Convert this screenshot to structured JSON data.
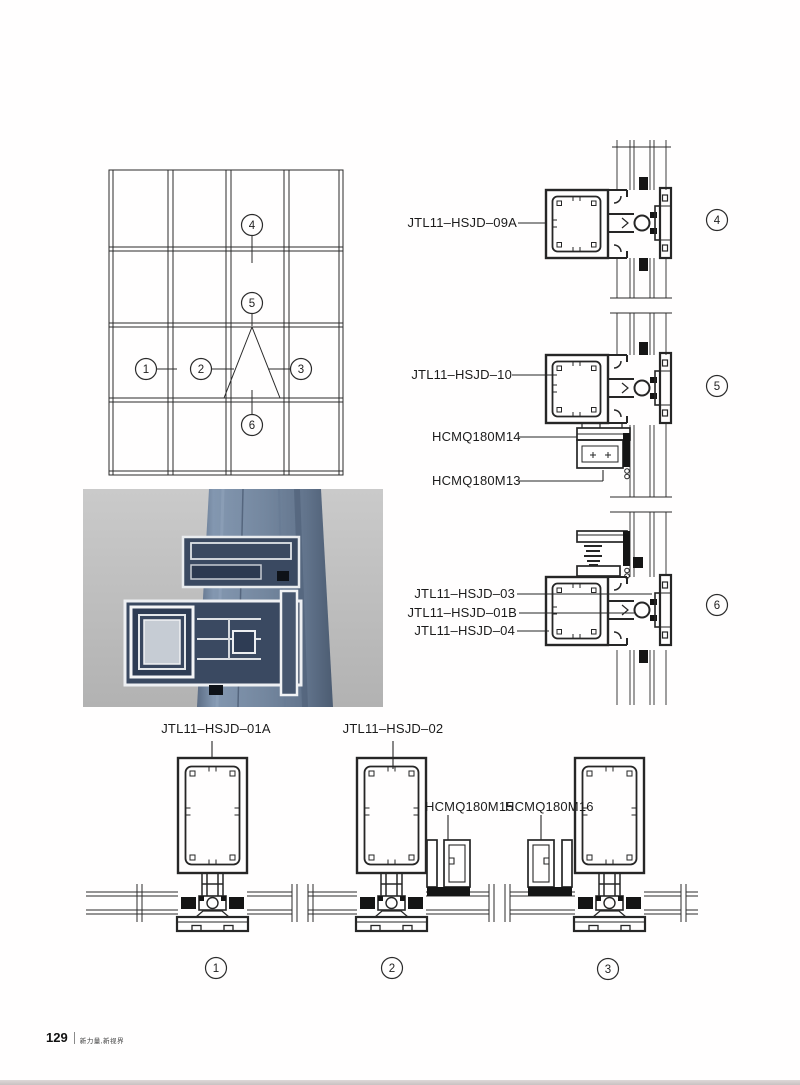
{
  "page": {
    "number": "129",
    "tagline": "新力量,新视界"
  },
  "colors": {
    "line": "#2b2b2b",
    "paper": "#fffefe",
    "photo_background": "#c4c4c4",
    "mullion_blue": "#74879f",
    "bottom_strip": "#d0c9c9"
  },
  "callouts": {
    "c1": "1",
    "c2": "2",
    "c3": "3",
    "c4": "4",
    "c5": "5",
    "c6": "6"
  },
  "labels": {
    "hsjd09a": "JTL11–HSJD–09A",
    "hsjd10": "JTL11–HSJD–10",
    "hcmq14": "HCMQ180M14",
    "hcmq13": "HCMQ180M13",
    "hsjd03": "JTL11–HSJD–03",
    "hsjd01b": "JTL11–HSJD–01B",
    "hsjd04": "JTL11–HSJD–04",
    "hsjd01a": "JTL11–HSJD–01A",
    "hsjd02": "JTL11–HSJD–02",
    "hcmq15": "HCMQ180M15",
    "hcmq16": "HCMQ180M16"
  }
}
